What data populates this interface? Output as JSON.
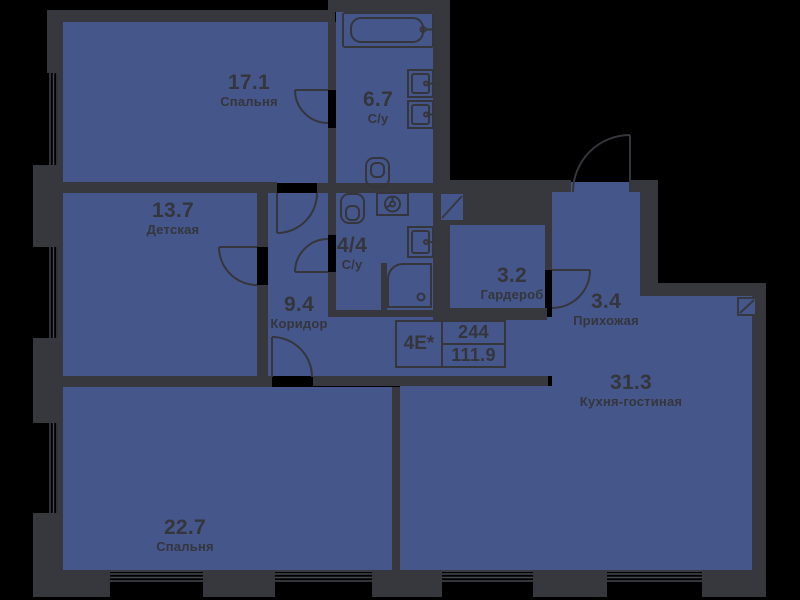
{
  "plan": {
    "colors": {
      "floor": "#45568B",
      "wall": "#37383D",
      "outside": "#000000",
      "text": "#34363B"
    },
    "rooms": [
      {
        "key": "bedroom-1",
        "area": "17.1",
        "name": "Спальня"
      },
      {
        "key": "bathroom-1",
        "area": "6.7",
        "name": "С/у"
      },
      {
        "key": "kids-room",
        "area": "13.7",
        "name": "Детская"
      },
      {
        "key": "bathroom-2",
        "area": "4/4",
        "name": "С/у"
      },
      {
        "key": "corridor",
        "area": "9.4",
        "name": "Коридор"
      },
      {
        "key": "wardrobe",
        "area": "3.2",
        "name": "Гардероб"
      },
      {
        "key": "hallway",
        "area": "3.4",
        "name": "Прихожая"
      },
      {
        "key": "kitchen-living",
        "area": "31.3",
        "name": "Кухня-гостиная"
      },
      {
        "key": "bedroom-2",
        "area": "22.7",
        "name": "Спальня"
      }
    ],
    "info_table": {
      "unit_type": "4E*",
      "unit_number": "244",
      "total_area": "111.9"
    }
  }
}
